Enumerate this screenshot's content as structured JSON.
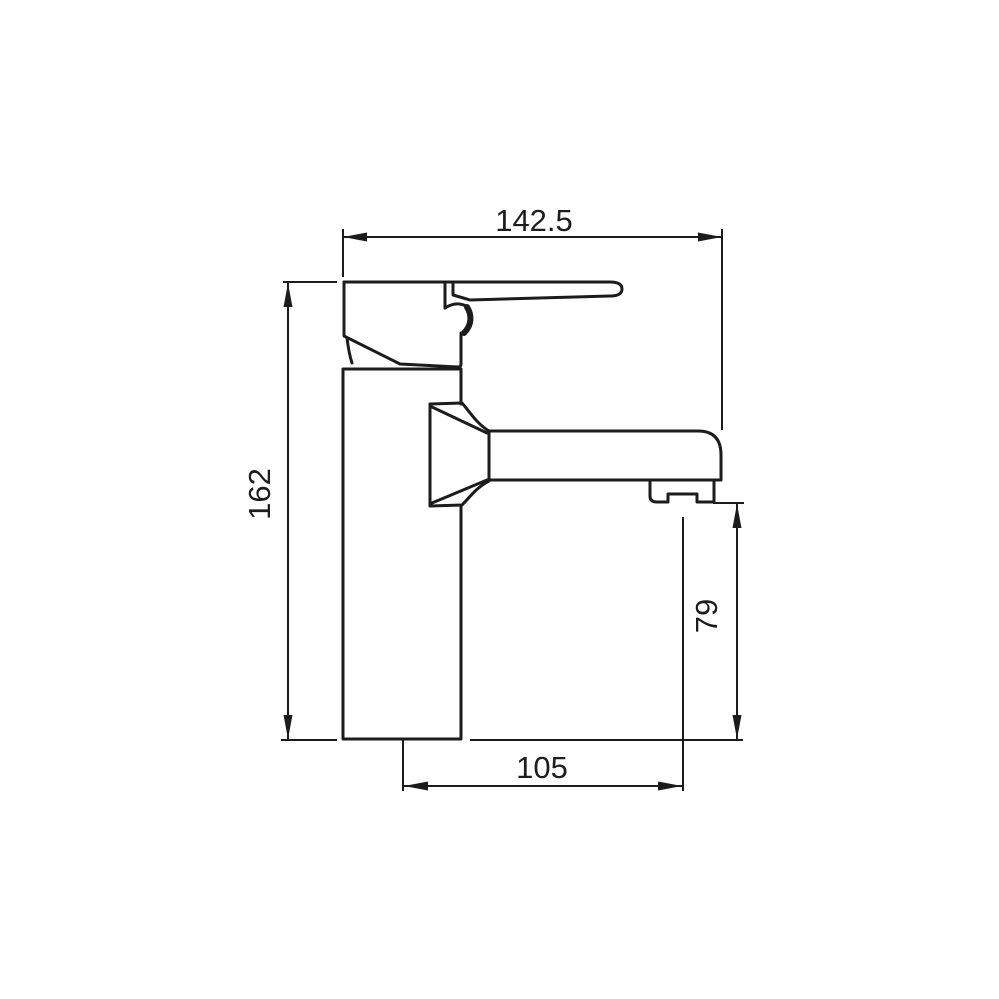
{
  "drawing": {
    "background_color": "#ffffff",
    "line_color": "#1c1c1c",
    "dimensions": {
      "overall_width": {
        "label": "142.5"
      },
      "overall_height": {
        "label": "162"
      },
      "outlet_height": {
        "label": "79"
      },
      "spout_reach": {
        "label": "105"
      }
    }
  }
}
